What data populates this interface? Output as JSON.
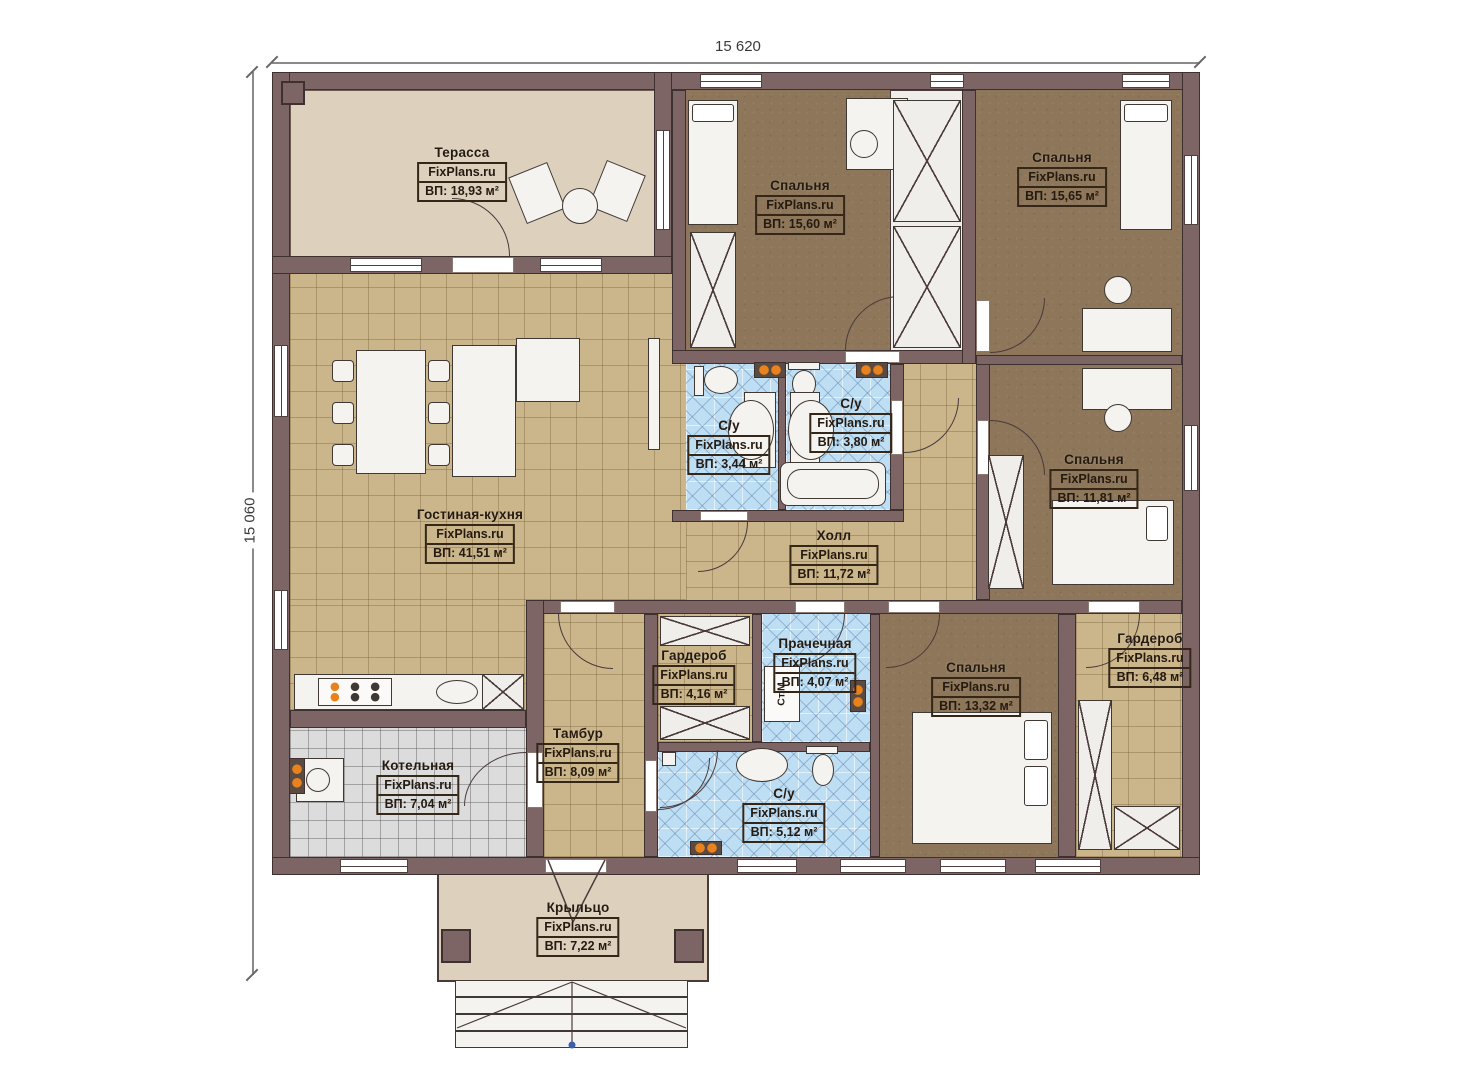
{
  "brand": "FixPlans.ru",
  "dimensions": {
    "top": "15 620",
    "left": "15 060"
  },
  "rooms": [
    {
      "name": "Терасса",
      "brand": "FixPlans.ru",
      "area": "ВП: 18,93 м²"
    },
    {
      "name": "Спальня",
      "brand": "FixPlans.ru",
      "area": "ВП: 15,60 м²"
    },
    {
      "name": "Спальня",
      "brand": "FixPlans.ru",
      "area": "ВП: 15,65 м²"
    },
    {
      "name": "С/у",
      "brand": "FixPlans.ru",
      "area": "ВП: 3,44 м²"
    },
    {
      "name": "С/у",
      "brand": "FixPlans.ru",
      "area": "ВП: 3,80 м²"
    },
    {
      "name": "Спальня",
      "brand": "FixPlans.ru",
      "area": "ВП: 11,81 м²"
    },
    {
      "name": "Гостиная-кухня",
      "brand": "FixPlans.ru",
      "area": "ВП: 41,51 м²"
    },
    {
      "name": "Холл",
      "brand": "FixPlans.ru",
      "area": "ВП: 11,72 м²"
    },
    {
      "name": "Гардероб",
      "brand": "FixPlans.ru",
      "area": "ВП: 4,16 м²"
    },
    {
      "name": "Прачечная",
      "brand": "FixPlans.ru",
      "area": "ВП: 4,07 м²"
    },
    {
      "name": "Спальня",
      "brand": "FixPlans.ru",
      "area": "ВП: 13,32 м²"
    },
    {
      "name": "Гардероб",
      "brand": "FixPlans.ru",
      "area": "ВП: 6,48 м²"
    },
    {
      "name": "Тамбур",
      "brand": "FixPlans.ru",
      "area": "ВП: 8,09 м²"
    },
    {
      "name": "Котельная",
      "brand": "FixPlans.ru",
      "area": "ВП: 7,04 м²"
    },
    {
      "name": "С/у",
      "brand": "FixPlans.ru",
      "area": "ВП: 5,12 м²"
    },
    {
      "name": "Крыльцо",
      "brand": "FixPlans.ru",
      "area": "ВП: 7,22 м²"
    }
  ],
  "appliances": {
    "washing_machine": "Ст.М"
  },
  "colors": {
    "wall": "#7d6565",
    "floor_tan": "#cbb58a",
    "floor_blue": "#bedef4",
    "floor_brown": "#8d7659",
    "floor_beige": "#ddd1be",
    "floor_gray": "#dcdcdc",
    "radiator_orange": "#e8821c"
  }
}
